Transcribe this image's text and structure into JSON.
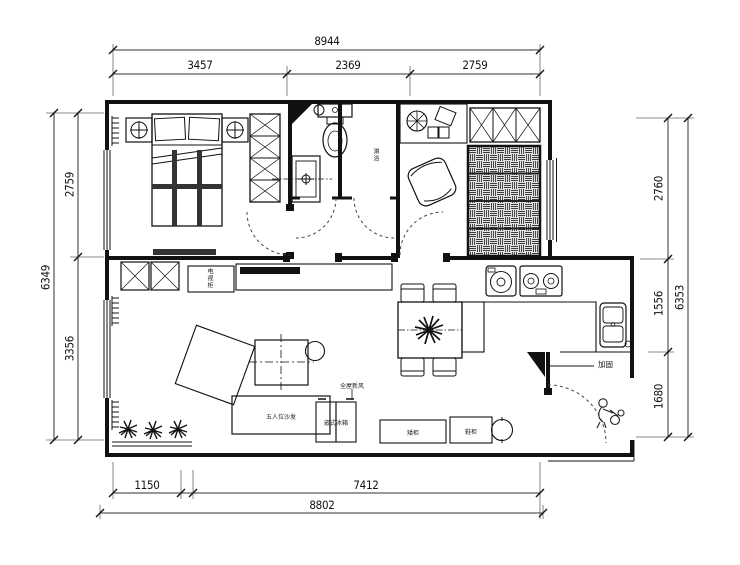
{
  "drawing": {
    "type": "apartment floor plan (CAD line drawing)",
    "units": "mm"
  },
  "dimensions": {
    "top": {
      "overall": "8944",
      "segments": [
        "3457",
        "2369",
        "2759"
      ]
    },
    "left": {
      "overall": "6349",
      "segments": [
        "2759",
        "3356"
      ]
    },
    "right": {
      "overall": "6353",
      "segments": [
        "2760",
        "1556",
        "1680"
      ]
    },
    "bottom": {
      "overall": "8802",
      "segments": [
        "1150",
        "7412"
      ]
    }
  },
  "labels": {
    "sofa": "五人位沙发",
    "fridge": "嵌式冰箱",
    "whole_house_note": "全屋新风",
    "tv_cabinet": "电视柜",
    "low_cabinet": "矮柜",
    "shoe_cabinet": "鞋柜",
    "shower_room": "淋浴",
    "reinforce": "加固"
  },
  "colors": {
    "line": "#111111",
    "dim_line": "#333333",
    "hatch": "#3a3a3a",
    "bg": "#ffffff"
  }
}
